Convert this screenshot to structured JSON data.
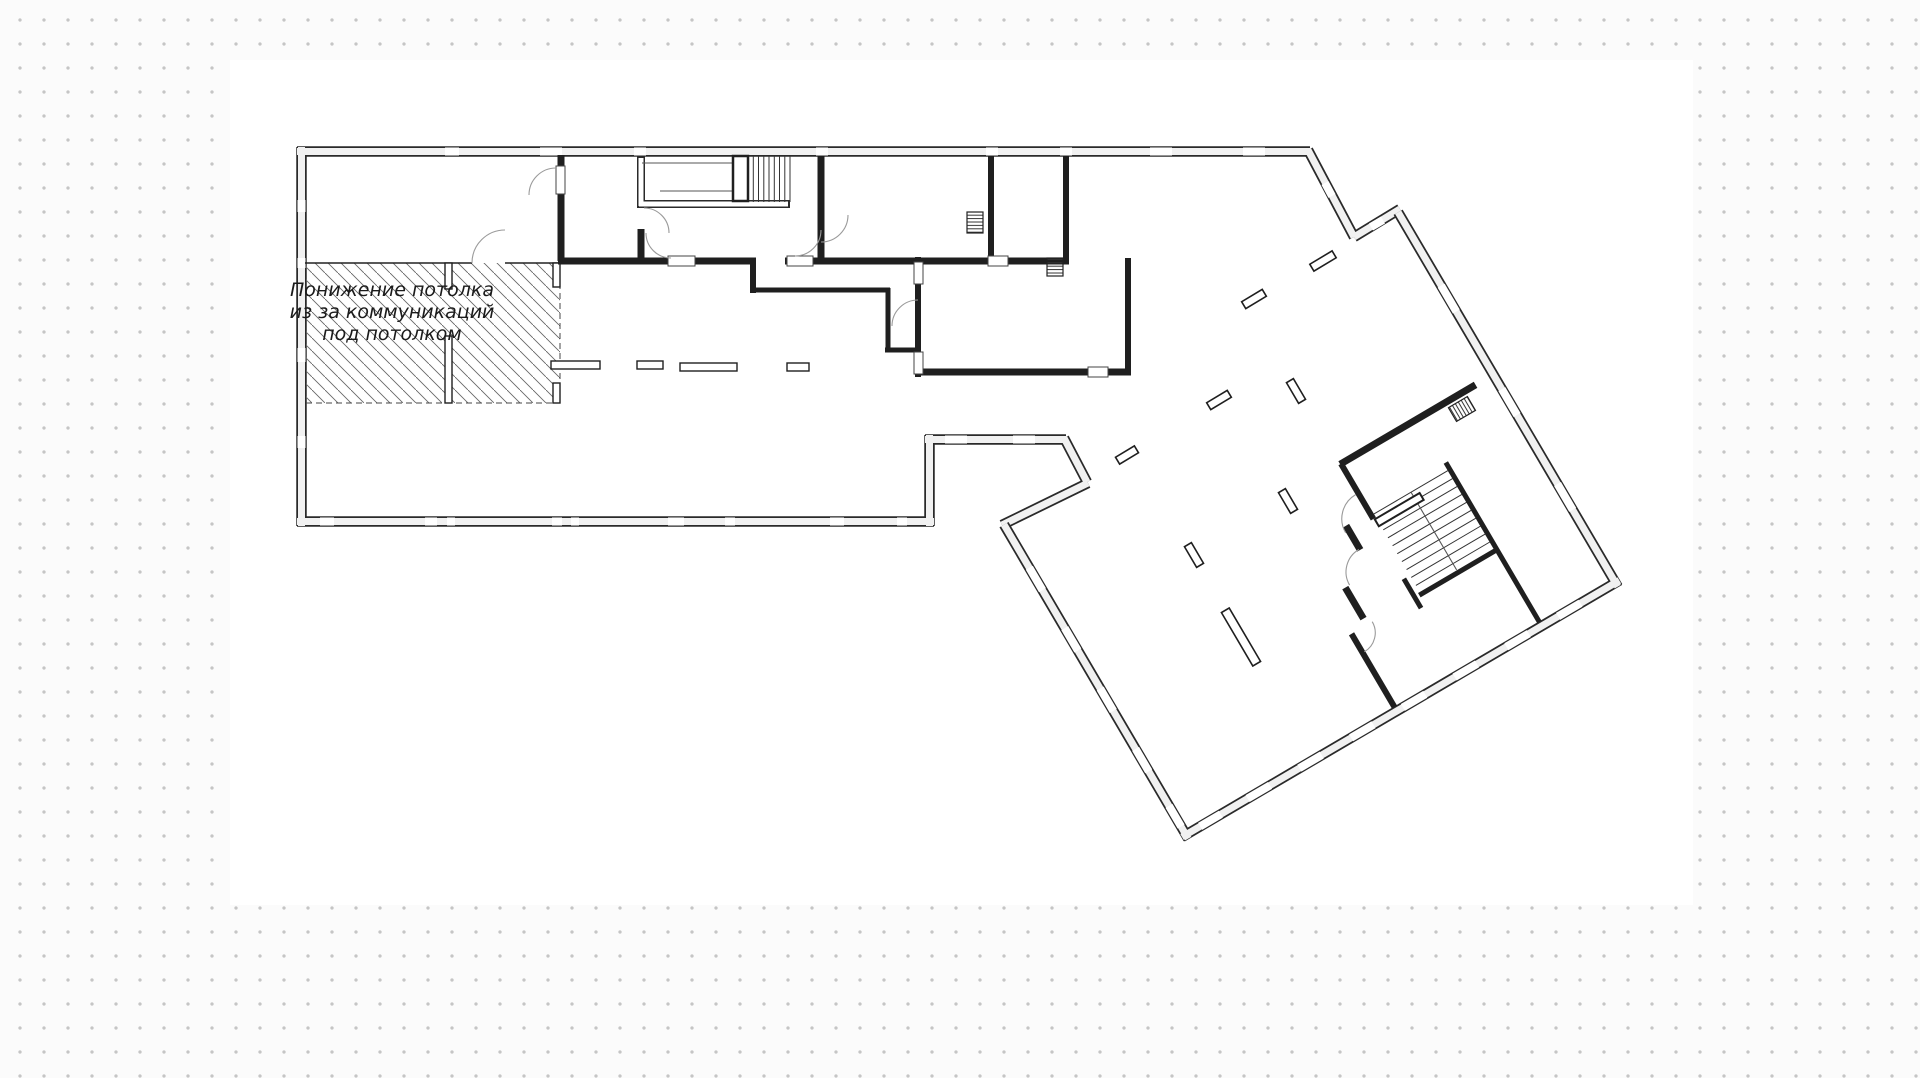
{
  "artboard": {
    "type": "floor-plan-drawing",
    "background": "#ffffff"
  },
  "floor_plan": {
    "annotation": {
      "line1": "Понижение потолка",
      "line2": "из за коммуникаций",
      "line3": "под потолком"
    },
    "colors": {
      "wall": "#1f1f1f",
      "band_fill": "#f1f1f1",
      "hatch_line": "#666666",
      "door_arc": "#999999",
      "canvas_dot": "#c5c5c5"
    },
    "features": {
      "hatched_zone": "lowered-ceiling-area",
      "stair_count": "2",
      "column_count": "8"
    }
  }
}
